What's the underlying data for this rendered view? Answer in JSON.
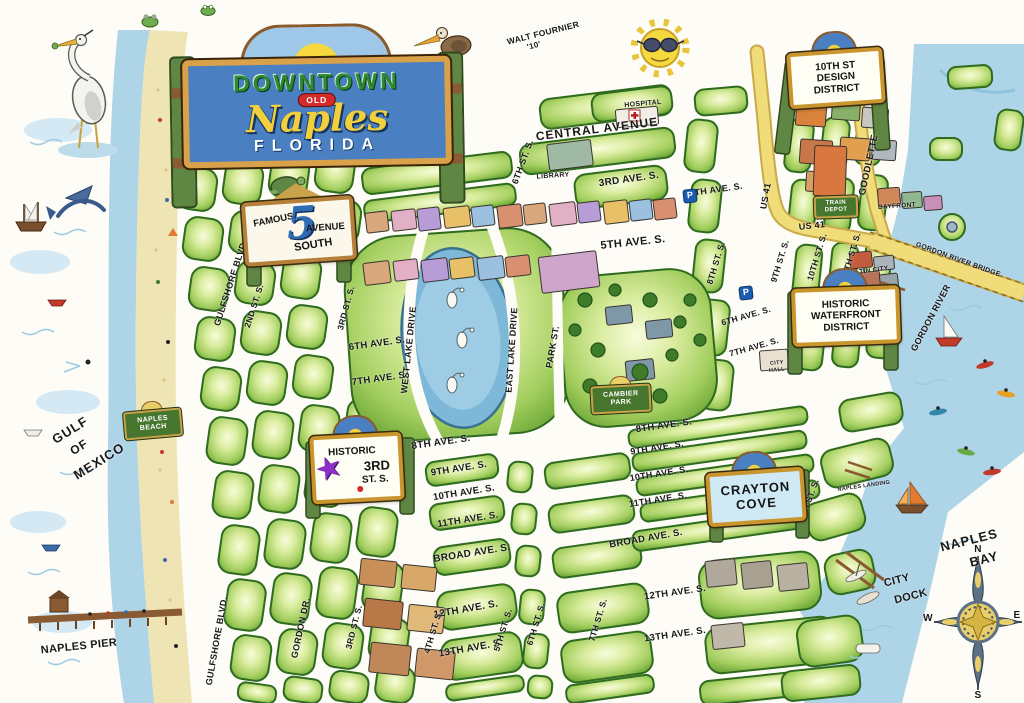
{
  "title_sign": {
    "downtown": "DOWNTOWN",
    "old": "OLD",
    "naples": "Naples",
    "florida": "FLORIDA"
  },
  "signature": {
    "line1": "WALT FOURNIER",
    "line2": "'10'"
  },
  "district_signs": {
    "design": {
      "line1": "10TH ST",
      "line2": "DESIGN",
      "line3": "DISTRICT"
    },
    "fifth_ave": {
      "famous": "FAMOUS",
      "numeral": "5",
      "avenue": "AVENUE",
      "south": "SOUTH"
    },
    "waterfront": {
      "line1": "HISTORIC",
      "line2": "WATERFRONT",
      "line3": "DISTRICT"
    },
    "third_st": {
      "line1": "HISTORIC",
      "line2": "3RD",
      "line3": "ST. S.",
      "star": "★",
      "dot": "●"
    },
    "crayton": {
      "line1": "CRAYTON",
      "line2": "COVE"
    },
    "naples_beach": {
      "line1": "NAPLES",
      "line2": "BEACH"
    },
    "cambier": {
      "line1": "CAMBIER",
      "line2": "PARK"
    },
    "train_depot": {
      "line1": "TRAIN",
      "line2": "DEPOT"
    }
  },
  "avenues": {
    "central": "CENTRAL AVENUE",
    "ave3": "3RD AVE. S.",
    "ave4": "4TH AVE. S.",
    "ave5": "5TH AVE. S.",
    "ave6": "6TH AVE. S.",
    "ave7": "7TH AVE. S.",
    "ave8": "8TH AVE. S.",
    "ave9": "9TH AVE. S.",
    "ave10": "10TH AVE. S.",
    "ave11": "11TH AVE. S.",
    "broad": "BROAD AVE. S.",
    "ave12": "12TH AVE. S.",
    "ave13": "13TH AVE. S."
  },
  "streets": {
    "gulfshore": "GULFSHORE BLVD.",
    "st2": "2ND ST. S.",
    "st3": "3RD ST. S.",
    "st4": "4TH ST. S.",
    "st5": "5TH ST. S.",
    "st6": "6TH ST. S.",
    "st7": "7TH ST. S.",
    "st8": "8TH ST. S.",
    "st9": "9TH ST. S.",
    "st10": "10TH ST. S.",
    "st11": "11TH ST. S.",
    "gordon_dr": "GORDON DR.",
    "west_lake": "WEST LAKE DRIVE",
    "east_lake": "EAST LAKE DRIVE",
    "park": "PARK ST.",
    "us41": "US 41",
    "goodlette": "GOODLETTE"
  },
  "places": {
    "gulf1": "GULF",
    "gulf2": "OF",
    "gulf3": "MEXICO",
    "naples_pier": "NAPLES PIER",
    "naples_bay1": "NAPLES",
    "naples_bay2": "BAY",
    "city_dock1": "CITY",
    "city_dock2": "DOCK",
    "gordon_river": "GORDON RIVER",
    "gordon_bridge": "GORDON RIVER BRIDGE",
    "tin_city": "TIN CITY",
    "bayfront": "BAYFRONT",
    "hospital": "HOSPITAL",
    "library": "LIBRARY",
    "city_hall1": "CITY",
    "city_hall2": "HALL",
    "naples_landing": "NAPLES LANDING",
    "parking": "P"
  },
  "compass": {
    "n": "N",
    "s": "S",
    "e": "E",
    "w": "W"
  },
  "colors": {
    "block_green": "#7cb342",
    "water_blue": "#aed4e8",
    "sand": "#efe4b4",
    "road_yellow": "#f0dd7a",
    "sign_blue": "#4a7fc1",
    "sign_gold": "#c9962e"
  }
}
